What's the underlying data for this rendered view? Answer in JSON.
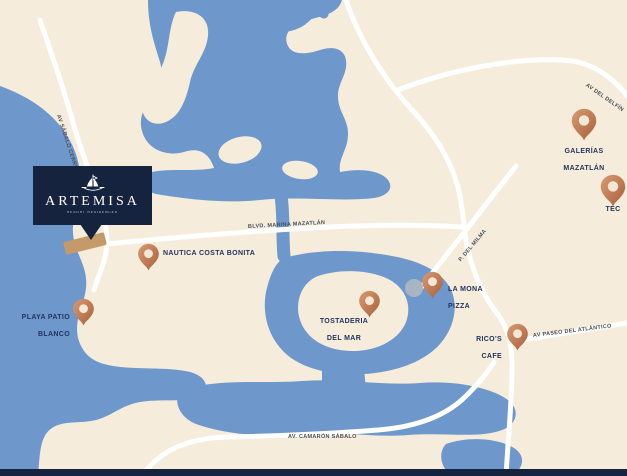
{
  "brand": {
    "name": "ARTEMISA",
    "tagline": "RESORT RESIDENCES"
  },
  "locations": {
    "nautica": {
      "line1": "NAUTICA COSTA BONITA",
      "line2": ""
    },
    "playa": {
      "line1": "PLAYA PATIO",
      "line2": "BLANCO"
    },
    "tostaderia": {
      "line1": "TOSTADERIA",
      "line2": "DEL MAR"
    },
    "lamona": {
      "line1": "LA MONA",
      "line2": "PIZZA"
    },
    "ricos": {
      "line1": "RICO'S",
      "line2": "CAFE"
    },
    "galerias": {
      "line1": "GALERÍAS",
      "line2": "MAZATLÁN"
    },
    "tec": {
      "line1": "TEC",
      "line2": ""
    }
  },
  "roads": {
    "sabalo_cerritos": "AV SÁBALO CERRITOS",
    "marina_mazatlan": "BLVD. MARINA MAZATLÁN",
    "p_del_milma": "P. DEL MILMA",
    "del_delfin": "AV DEL DELFÍN",
    "paseo_atlantico": "AV PASEO DEL ATLÁNTICO",
    "camaron_sabalo": "AV. CAMARÓN SÁBALO"
  },
  "colors": {
    "water": "#6E97CC",
    "land": "#F5ECDC",
    "road": "#FFFFFF",
    "pin_light": "#D79B72",
    "pin_dark": "#A85F3B",
    "pin_hole": "#F3E8D7",
    "brand_navy": "#16233E",
    "label_navy": "#23345C",
    "parcel_tan": "#C59A6B"
  }
}
